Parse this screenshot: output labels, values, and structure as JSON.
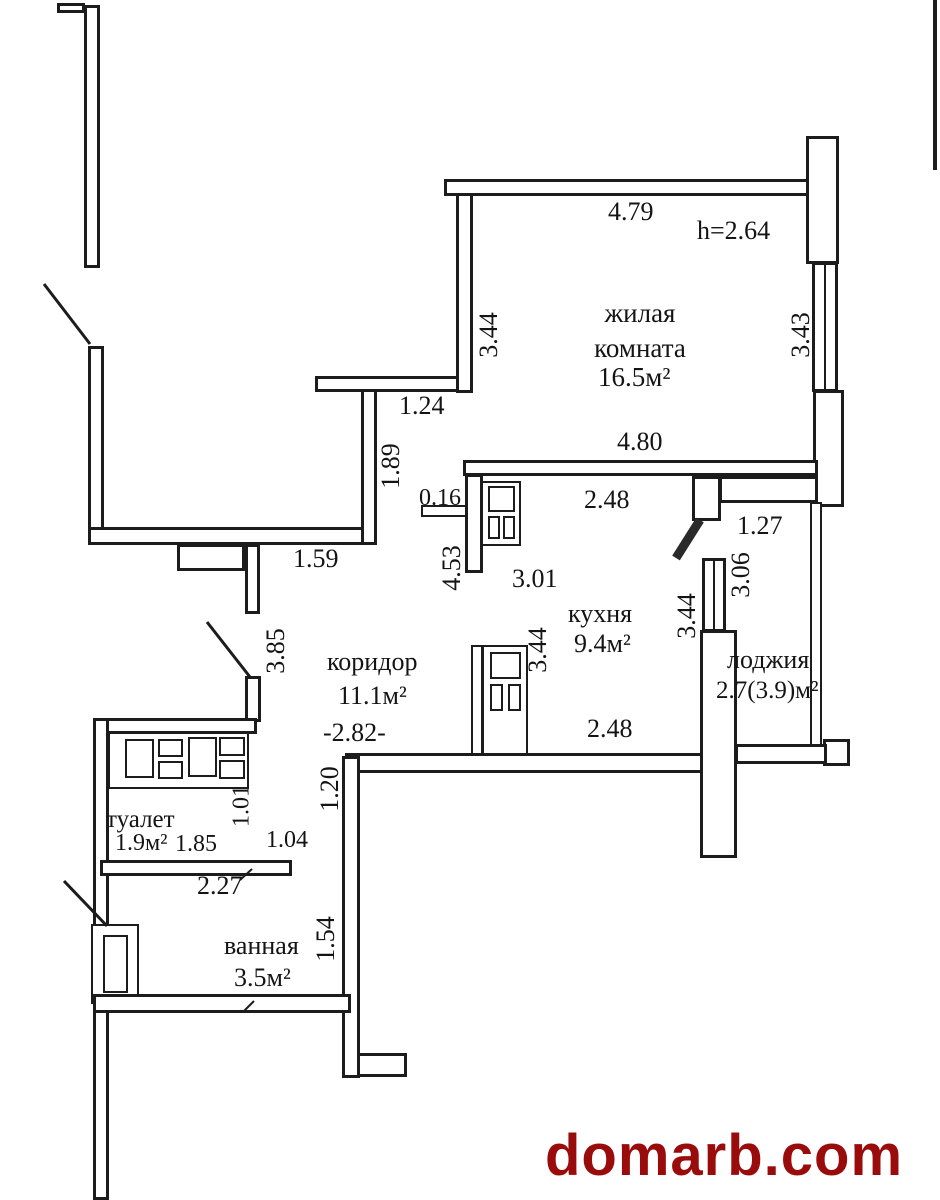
{
  "plan": {
    "height_note": "h=2.64",
    "rooms": {
      "living": {
        "name": "жилая комната",
        "area": "16.5м²"
      },
      "kitchen": {
        "name": "кухня",
        "area": "9.4м²"
      },
      "corridor": {
        "name": "коридор",
        "area": "11.1м²"
      },
      "toilet": {
        "name": "туалет",
        "area": "1.9м²"
      },
      "bath": {
        "name": "ванная",
        "area": "3.5м²"
      },
      "loggia": {
        "name": "лоджия",
        "area": "2.7(3.9)м²"
      }
    },
    "dims": {
      "d479": "4.79",
      "d344_living": "3.44",
      "d343": "3.43",
      "d480": "4.80",
      "d124": "1.24",
      "d189": "1.89",
      "d159": "1.59",
      "d016": "0.16",
      "d248_top": "2.48",
      "d127": "1.27",
      "d453": "4.53",
      "d301": "3.01",
      "d344_kitchen": "3.44",
      "d344_loggia": "3.44",
      "d306": "3.06",
      "d248_bottom": "2.48",
      "d385": "3.85",
      "d282": "-2.82-",
      "d120": "1.20",
      "d101": "1.01",
      "d185": "1.85",
      "d104": "1.04",
      "d227": "2.27",
      "d154": "1.54"
    }
  },
  "watermark": {
    "text": "domarb.com",
    "color": "#9a0b0b"
  }
}
